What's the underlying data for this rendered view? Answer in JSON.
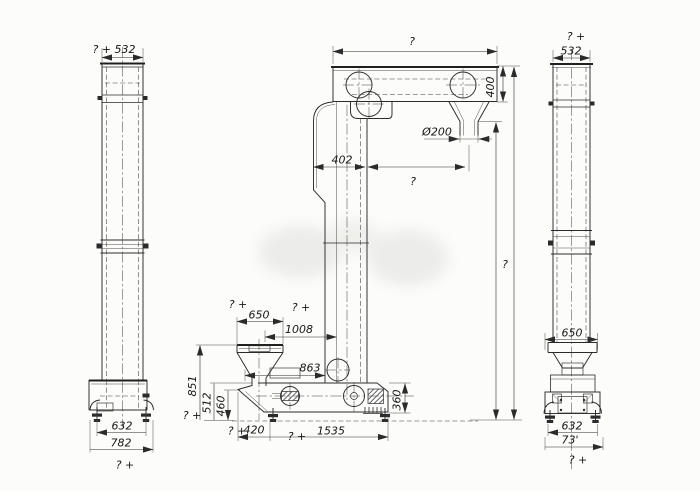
{
  "drawing": {
    "description": "Three-view engineering dimension drawing of a Z-type bucket elevator (left side view, front view, right side view)",
    "background_color": "#fcfcfb",
    "line_color": "#2b2b2b",
    "watermark_color": "#ececea"
  },
  "left_view": {
    "top_width": "? + 532",
    "base_inner": "632",
    "base_outer": "782",
    "bottom_note": "? +"
  },
  "front_view": {
    "top_width": "?",
    "head_height": "400",
    "spout_diameter": "Ø200",
    "leg_width": "402",
    "leg_to_spout": "?",
    "overall_height": "?",
    "hopper_note": "? +",
    "hopper_width": "650",
    "offset_note": "? +",
    "offset": "1008",
    "hopper_to_leg": "863",
    "hopper_height": "851",
    "lip_height": "512",
    "boot_top_height": "460",
    "ground_note": "? +",
    "boot_height": "360",
    "base_note": "? +",
    "base_left": "420",
    "span_note": "? +",
    "span": "1535"
  },
  "right_view": {
    "top_note": "? +",
    "top_width": "532",
    "boot_width": "650",
    "base_inner": "632",
    "base_outer": "73'",
    "bottom_note": "? +"
  }
}
